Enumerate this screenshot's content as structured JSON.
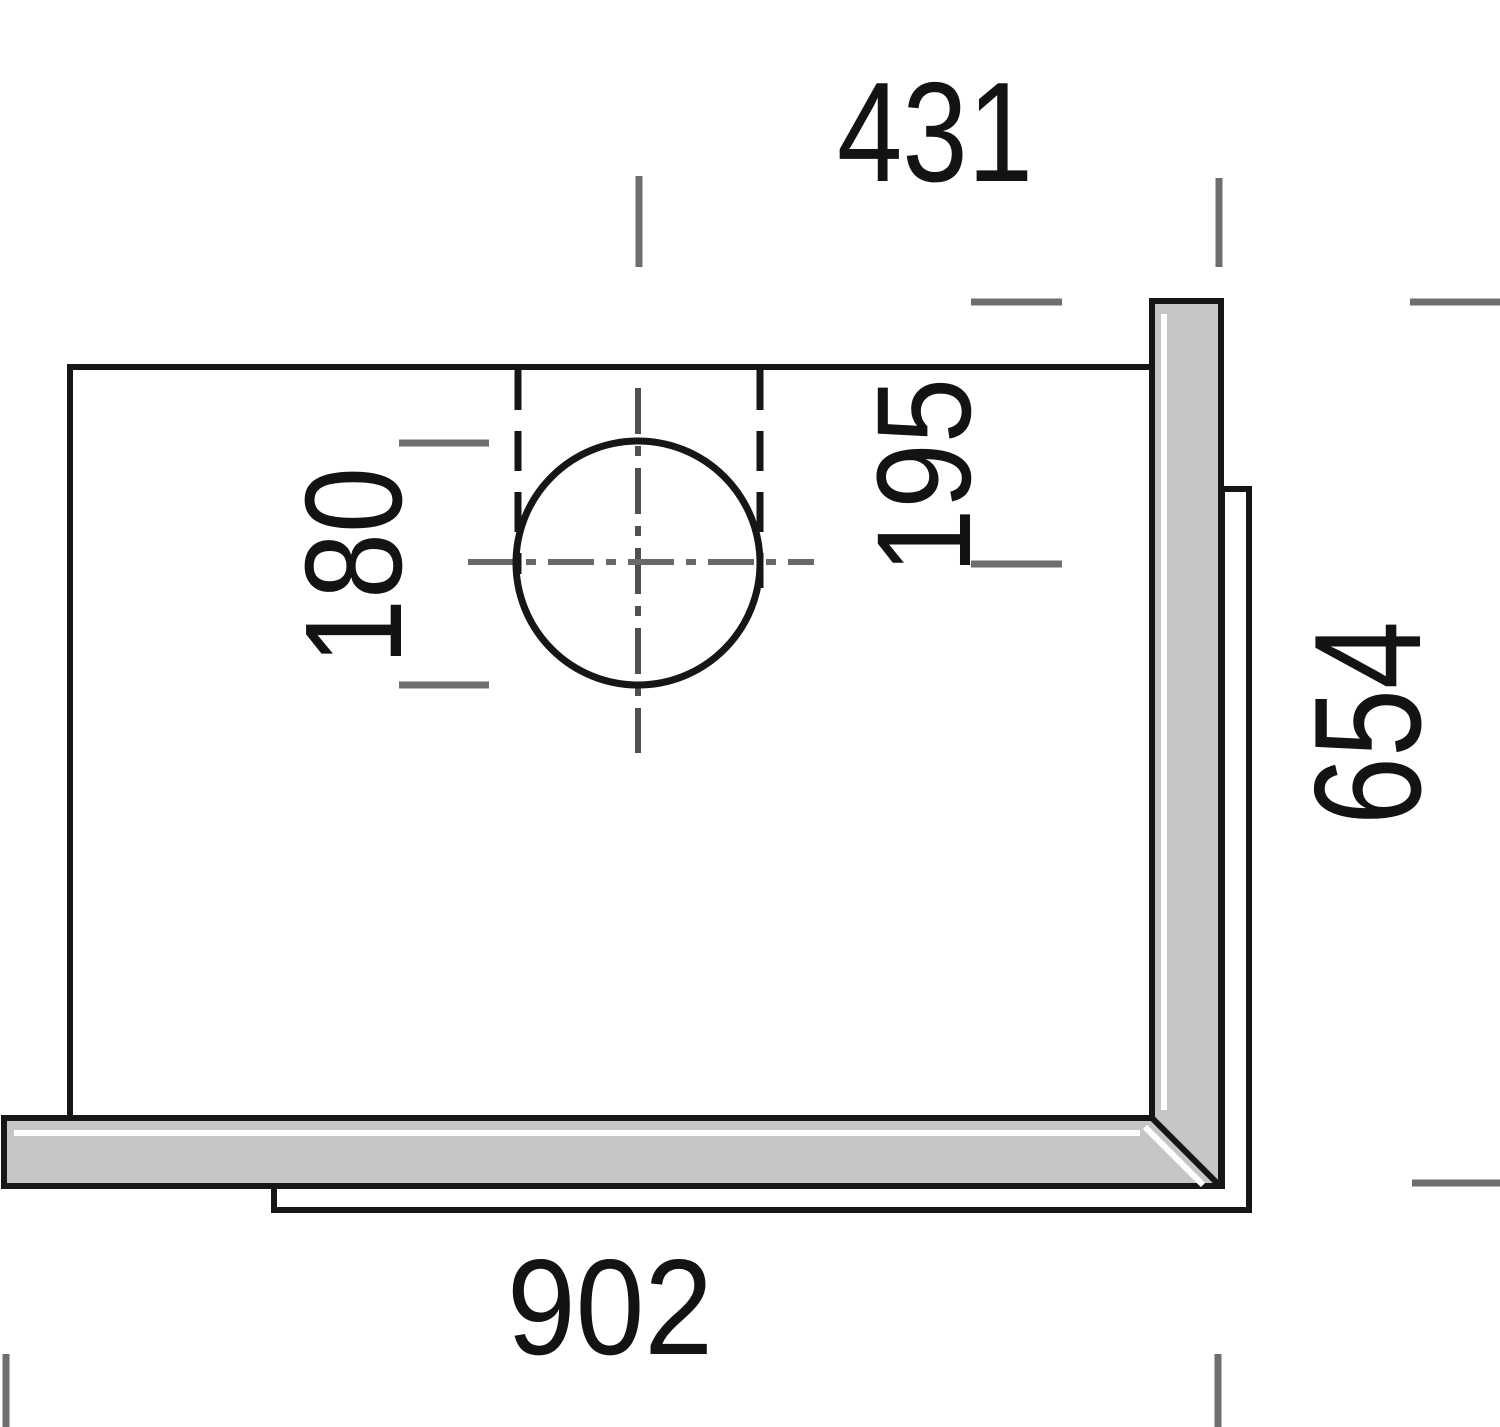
{
  "diagram": {
    "type": "technical-drawing-plan-view",
    "subject": "worktop panel with round hole cutout and L-shaped edge strips",
    "colors": {
      "background": "#ffffff",
      "line": "#161616",
      "tick": "#6e6e6e",
      "centerline": "#5a5a5a",
      "panel_fill": "#c6c6c6",
      "panel_highlight": "#ffffff",
      "text": "#131313"
    },
    "dimensions": {
      "hole_center_to_right_edge": "431",
      "back_edge_to_hole_center": "195",
      "hole_diameter": "180",
      "side_depth": "654",
      "front_width": "902"
    }
  }
}
